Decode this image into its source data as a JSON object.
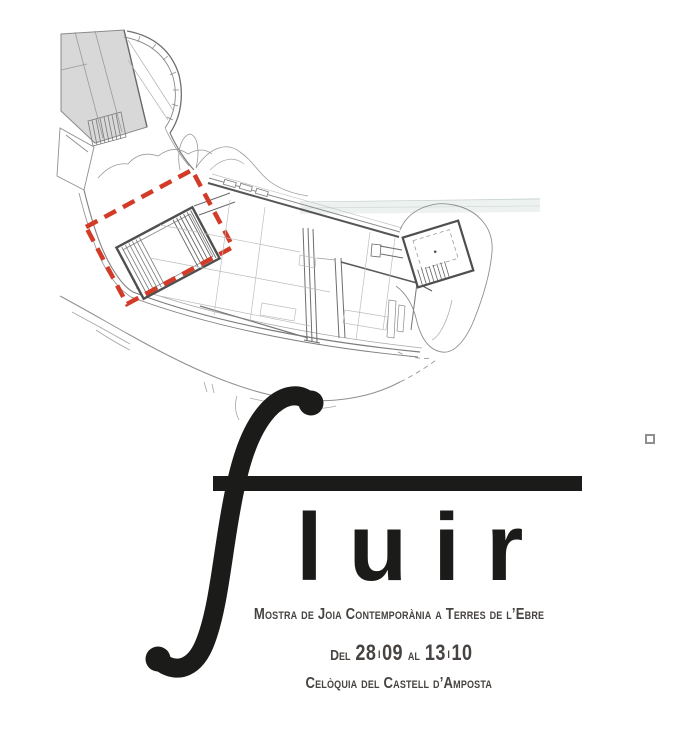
{
  "title": {
    "initial": "f",
    "rest": "luir"
  },
  "subtitle": "Mostra de Joia Contemporània a Terres de l’Ebre",
  "dates": {
    "prefix": "Del",
    "start_day": "28",
    "separator": "I",
    "start_month": "09",
    "connector": "al",
    "end_day": "13",
    "end_month": "10"
  },
  "venue": "Celòquia del Castell d’Amposta",
  "plan": {
    "type": "architectural-site-plan",
    "subject": "Castell d'Amposta",
    "highlight_color": "#d23b27",
    "building_fill": "#d8d8d8",
    "line_color": "#8f8f8f",
    "wall_color": "#555555",
    "band_tint": "#e9efee",
    "ink_color": "#1b1b19",
    "text_color": "#474341",
    "background": "#ffffff"
  }
}
